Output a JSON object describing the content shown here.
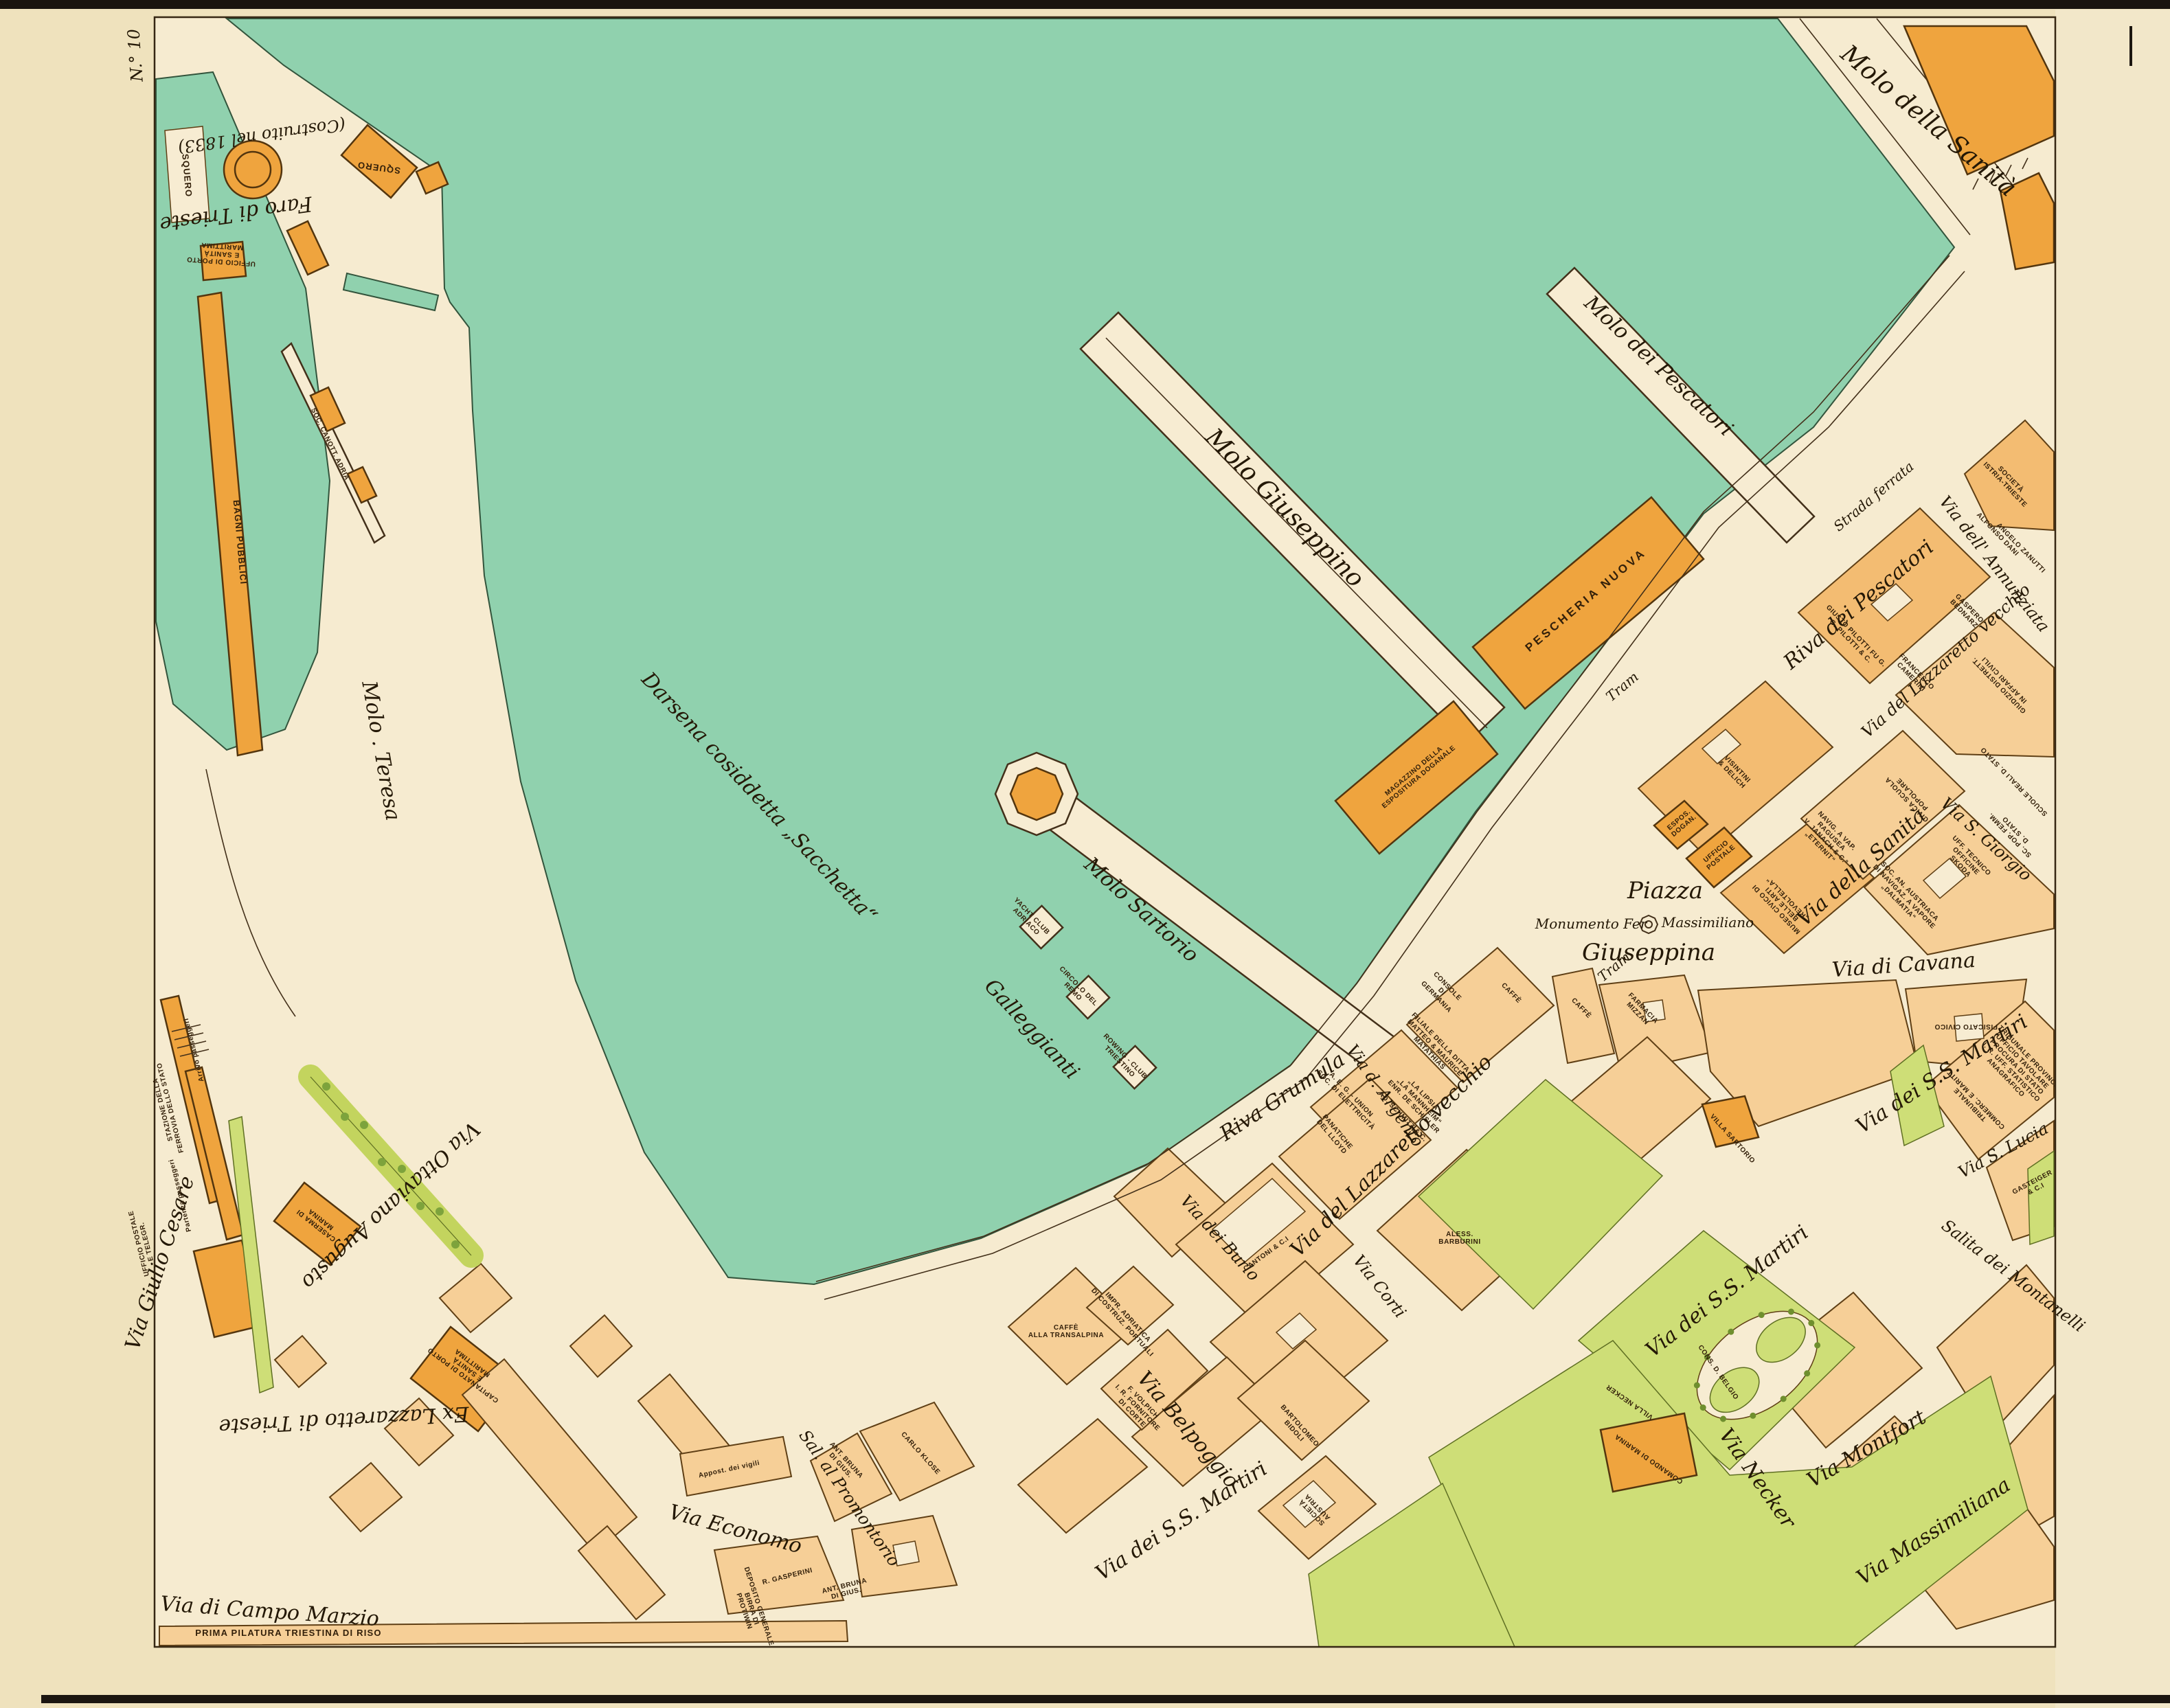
{
  "colors": {
    "paper": "#efe2bd",
    "map_land": "#f6ebd0",
    "water": "#90d1ae",
    "block_pale": "#f6cf97",
    "block_mid": "#f3bc72",
    "building_deep": "#efa43e",
    "green": "#cede77",
    "line": "#43301a"
  },
  "sheet": {
    "number": "N.° 10"
  },
  "labels": {
    "water": {
      "darsena": "Darsena cosiddetta „Sacchetta“",
      "galleggianti": "Galleggianti"
    },
    "piers": {
      "sanita": "Molo della Sanità",
      "pescatori": "Molo dei Pescatori",
      "giuseppino": "Molo Giuseppino",
      "sartorio": "Molo Sartorio",
      "teresa": "Molo . Teresa"
    },
    "streets": {
      "riva_pescatori": "Riva dei Pescatori",
      "strada_ferrata": "Strada ferrata",
      "tram": "Tram",
      "riva_grumula": "Riva Grumula",
      "argento": "Via d. Argento",
      "lazzaretto": "Via del Lazzaretto vecchio",
      "annunziata": "Via dell' Annunziata",
      "burlo": "Via dei Burlo",
      "corti": "Via Corti",
      "belpoggio": "Via Belpoggio",
      "ss_martiri": "Via dei S.S. Martiri",
      "necker": "Via Necker",
      "montfort": "Via Montfort",
      "massimiliana": "Via Massimiliana",
      "montanelli": "Salita dei Montanelli",
      "s_lucia": "Via S. Lucia",
      "cavana": "Via di Cavana",
      "sanita": "Via della Sanità",
      "s_giorgio": "Via S. Giorgio",
      "economo": "Via Economo",
      "promontorio": "Sal. al Promontorio",
      "campo_marzio": "Via di Campo Marzio",
      "giulio_cesare": "Via Giulio Cesare",
      "ottaviano": "Via Ottaviano Augusto"
    },
    "piazza": {
      "piazza": "Piazza",
      "giuseppina": "Giuseppina",
      "monumento_pre": "Monumento Fer",
      "monumento_post": "Massimiliano"
    },
    "areas": {
      "faro": "Faro di Trieste",
      "costruito": "(Costruito nel 1833)",
      "ex_lazzaretto": "Ex Lazzaretto di Trieste",
      "villa_necker": "VILLA NECKER"
    },
    "buildings": {
      "squero": "SQUERO",
      "ufficio_porto": "UFFICIO DI PORTO\nE SANITÀ\nMARITTIMA",
      "soc_canott": "SOC. CANOTT. ADRIA",
      "bagni": "BAGNI PUBBLICI",
      "stazione": "STAZIONE DELLA\nFERROVIA DELLO STATO",
      "arrivo": "Arrivo passeggeri",
      "partenza": "Partenza passeggeri",
      "posta_ferr": "UFFICIO POSTALE\nE TELEGR.",
      "caserma": "CASERMA DI\nMARINA",
      "capitanato": "CAPITANATO DI PORTO\nE SANITÀ\nMARITTIMA",
      "pilatura": "PRIMA PILATURA TRIESTINA DI RISO",
      "pescheria": "PESCHERIA NUOVA",
      "magazzino": "MAGAZZINO DELLA\nESPOSITURA DOGANALE",
      "espos_dogan": "ESPOS.\nDOGAN.",
      "ufficio_postale": "UFFICIO\nPOSTALE",
      "visintini": "VISINTINI\n& DELICH",
      "pilotti": "GIUSTO PILOTTI FU G.\nG. PILOTTI & C.",
      "camerini": "FRANCESCO\nCAMERINI",
      "bednarz": "GASPERO\nBEDNARZ",
      "istria": "SOCIETÀ\nISTRIA-TRIESTE",
      "dani": "ALFONSO DANI",
      "zanutti": "ANGELO ZANUTTI",
      "giudizio": "GIUDIZIO DISTRETT.\nIN AFFARI CIVILI",
      "scuole_reali": "SCUOLE REALI D. STATO",
      "sc_pop": "SC. POP. FEMM.\nD. STATO",
      "civica": "CIVICA SCUOLA\nPOPOLARE",
      "ragusea": "NAVIG. A VAP.\nRAGUSEA\nV. JANACH & C.º\n„ETERNIT“",
      "skoda": "UFF. TECNICO\nOFFICINE\nSKODA",
      "dalmatia": "SOC. AN. AUSTRIACA\nDI NAVIGAZ. A VAPORE\n„DALMATIA“",
      "museo": "MUSEO CIVICO DI\nBELLE ARTI\n„REVOLTELLA“",
      "fisicato": "FISICATO CIVICO",
      "farmacia": "FARMACIA\nMIZZAN",
      "caffe": "CAFFÈ",
      "console": "CONSOLE\nDI\nGERMANIA",
      "matathias": "FILIALE DELLA DITTA\nMATTEO & MAURICE\nMATATHIAS",
      "lipsia": "„LA LIPSIA“\n„LA MANNHEIM“\nENR. DE SCHISLER",
      "aeg": "A. E. G. - UNION\nSOC. DI ELETTRICITÀ",
      "schmitz": "AD. SCHMITZ & C.",
      "cantoni": "CANTONI & C.I",
      "panatiche": "PANATICHE\nDEL LLOYD",
      "impr": "IMPR. ADRIATICA\nDI COSTRUZ. PORTUALI",
      "transalpina": "CAFFÈ\nALLA TRANSALPINA",
      "volpich": "F. VOLPICH\nI. R. FORNITORE\nDI CORTE",
      "bidoli": "BARTOLOMEO\nBIDOLI",
      "austria": "SOCIETÀ\nAUSTRIA",
      "barburini": "ALESS.\nBARBURINI",
      "villa_sartorio": "VILLA SARTORIO",
      "comando": "COMANDO DI MARINA",
      "belgio": "CONS. D. BELGIO",
      "tribunale": "TRIBUNALE\nCOMMERC. E MARITT.",
      "trib_prov": "TRIBUNALE PROVINC.\nUFFICIO TAVOLARE\nPROCURA DI STATO\nI. R. UFF. STATISTICO\nANAGRAFICO",
      "gasteiger": "GASTEIGER\n& C.I",
      "gasperini": "R. GASPERINI",
      "bruna": "ANT. BRUNA\nDI GIUS.",
      "klose": "CARLO KLOSE",
      "birra": "DEPOSITO GENERALE\nBIRRA DI\nPROTIWIN",
      "vigili": "Appost. dei vigili",
      "yacht": "YACHT CLUB\nADRIACO",
      "remo": "CIRCOLO DEL\nREMO",
      "rowing": "ROWING - CLUB\nTRIESTINO"
    }
  }
}
